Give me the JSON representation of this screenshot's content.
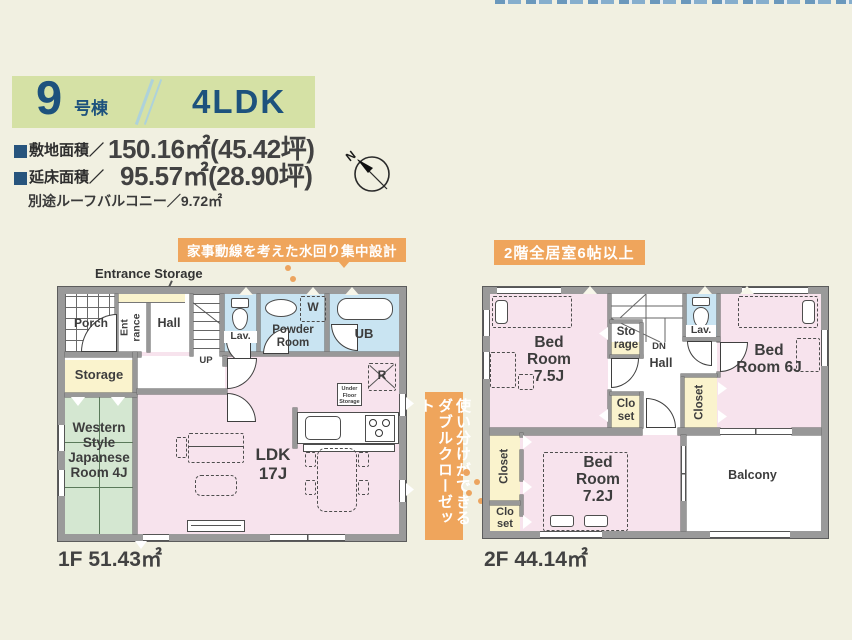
{
  "colors": {
    "background": "#f1f0e1",
    "header_band_green": "#d5e1a5",
    "navy_text": "#1d527d",
    "accent_orange": "#efa55c",
    "room_pink": "#f7e3ed",
    "room_blue": "#c9e4f2",
    "room_yellow": "#faf3cd",
    "tatami_green": "#d4e7d1",
    "wall_gray": "#9a9a9a"
  },
  "header": {
    "unit_number": "9",
    "unit_label": "号棟",
    "plan_type": "4LDK",
    "site_area_label": "敷地面積／",
    "site_area_value": "150.16㎡(45.42坪)",
    "floor_area_label": "延床面積／",
    "floor_area_value": "95.57㎡(28.90坪)",
    "roof_balcony_note": "別途ルーフバルコニー／9.72㎡",
    "compass_n": "N"
  },
  "callouts": {
    "water_design": "家事動線を考えた水回り集中設計",
    "second_floor_rooms": "2階全居室6帖以上",
    "double_closet": "使い分けができるダブルクローゼット"
  },
  "floor1": {
    "area_label": "1F 51.43㎡",
    "entrance_storage_label": "Entrance Storage",
    "rooms": {
      "porch": "Porch",
      "entrance": "Ent rance",
      "hall": "Hall",
      "stairs_up": "UP",
      "lavatory": "Lav.",
      "powder_room": "Powder Room",
      "bath": "UB",
      "washer": "W",
      "storage": "Storage",
      "japanese_room": "Western Style Japanese Room 4J",
      "ldk": "LDK 17J",
      "fridge": "R",
      "under_floor_storage": "Under Floor Storage"
    }
  },
  "floor2": {
    "area_label": "2F 44.14㎡",
    "rooms": {
      "bedroom_75": "Bed Room 7.5J",
      "storage": "Sto rage",
      "stairs_down": "DN",
      "hall": "Hall",
      "lavatory": "Lav.",
      "bedroom_6": "Bed Room 6J",
      "closet": "Closet",
      "closet_small": "Clo set",
      "bedroom_72": "Bed Room 7.2J",
      "balcony": "Balcony"
    }
  }
}
